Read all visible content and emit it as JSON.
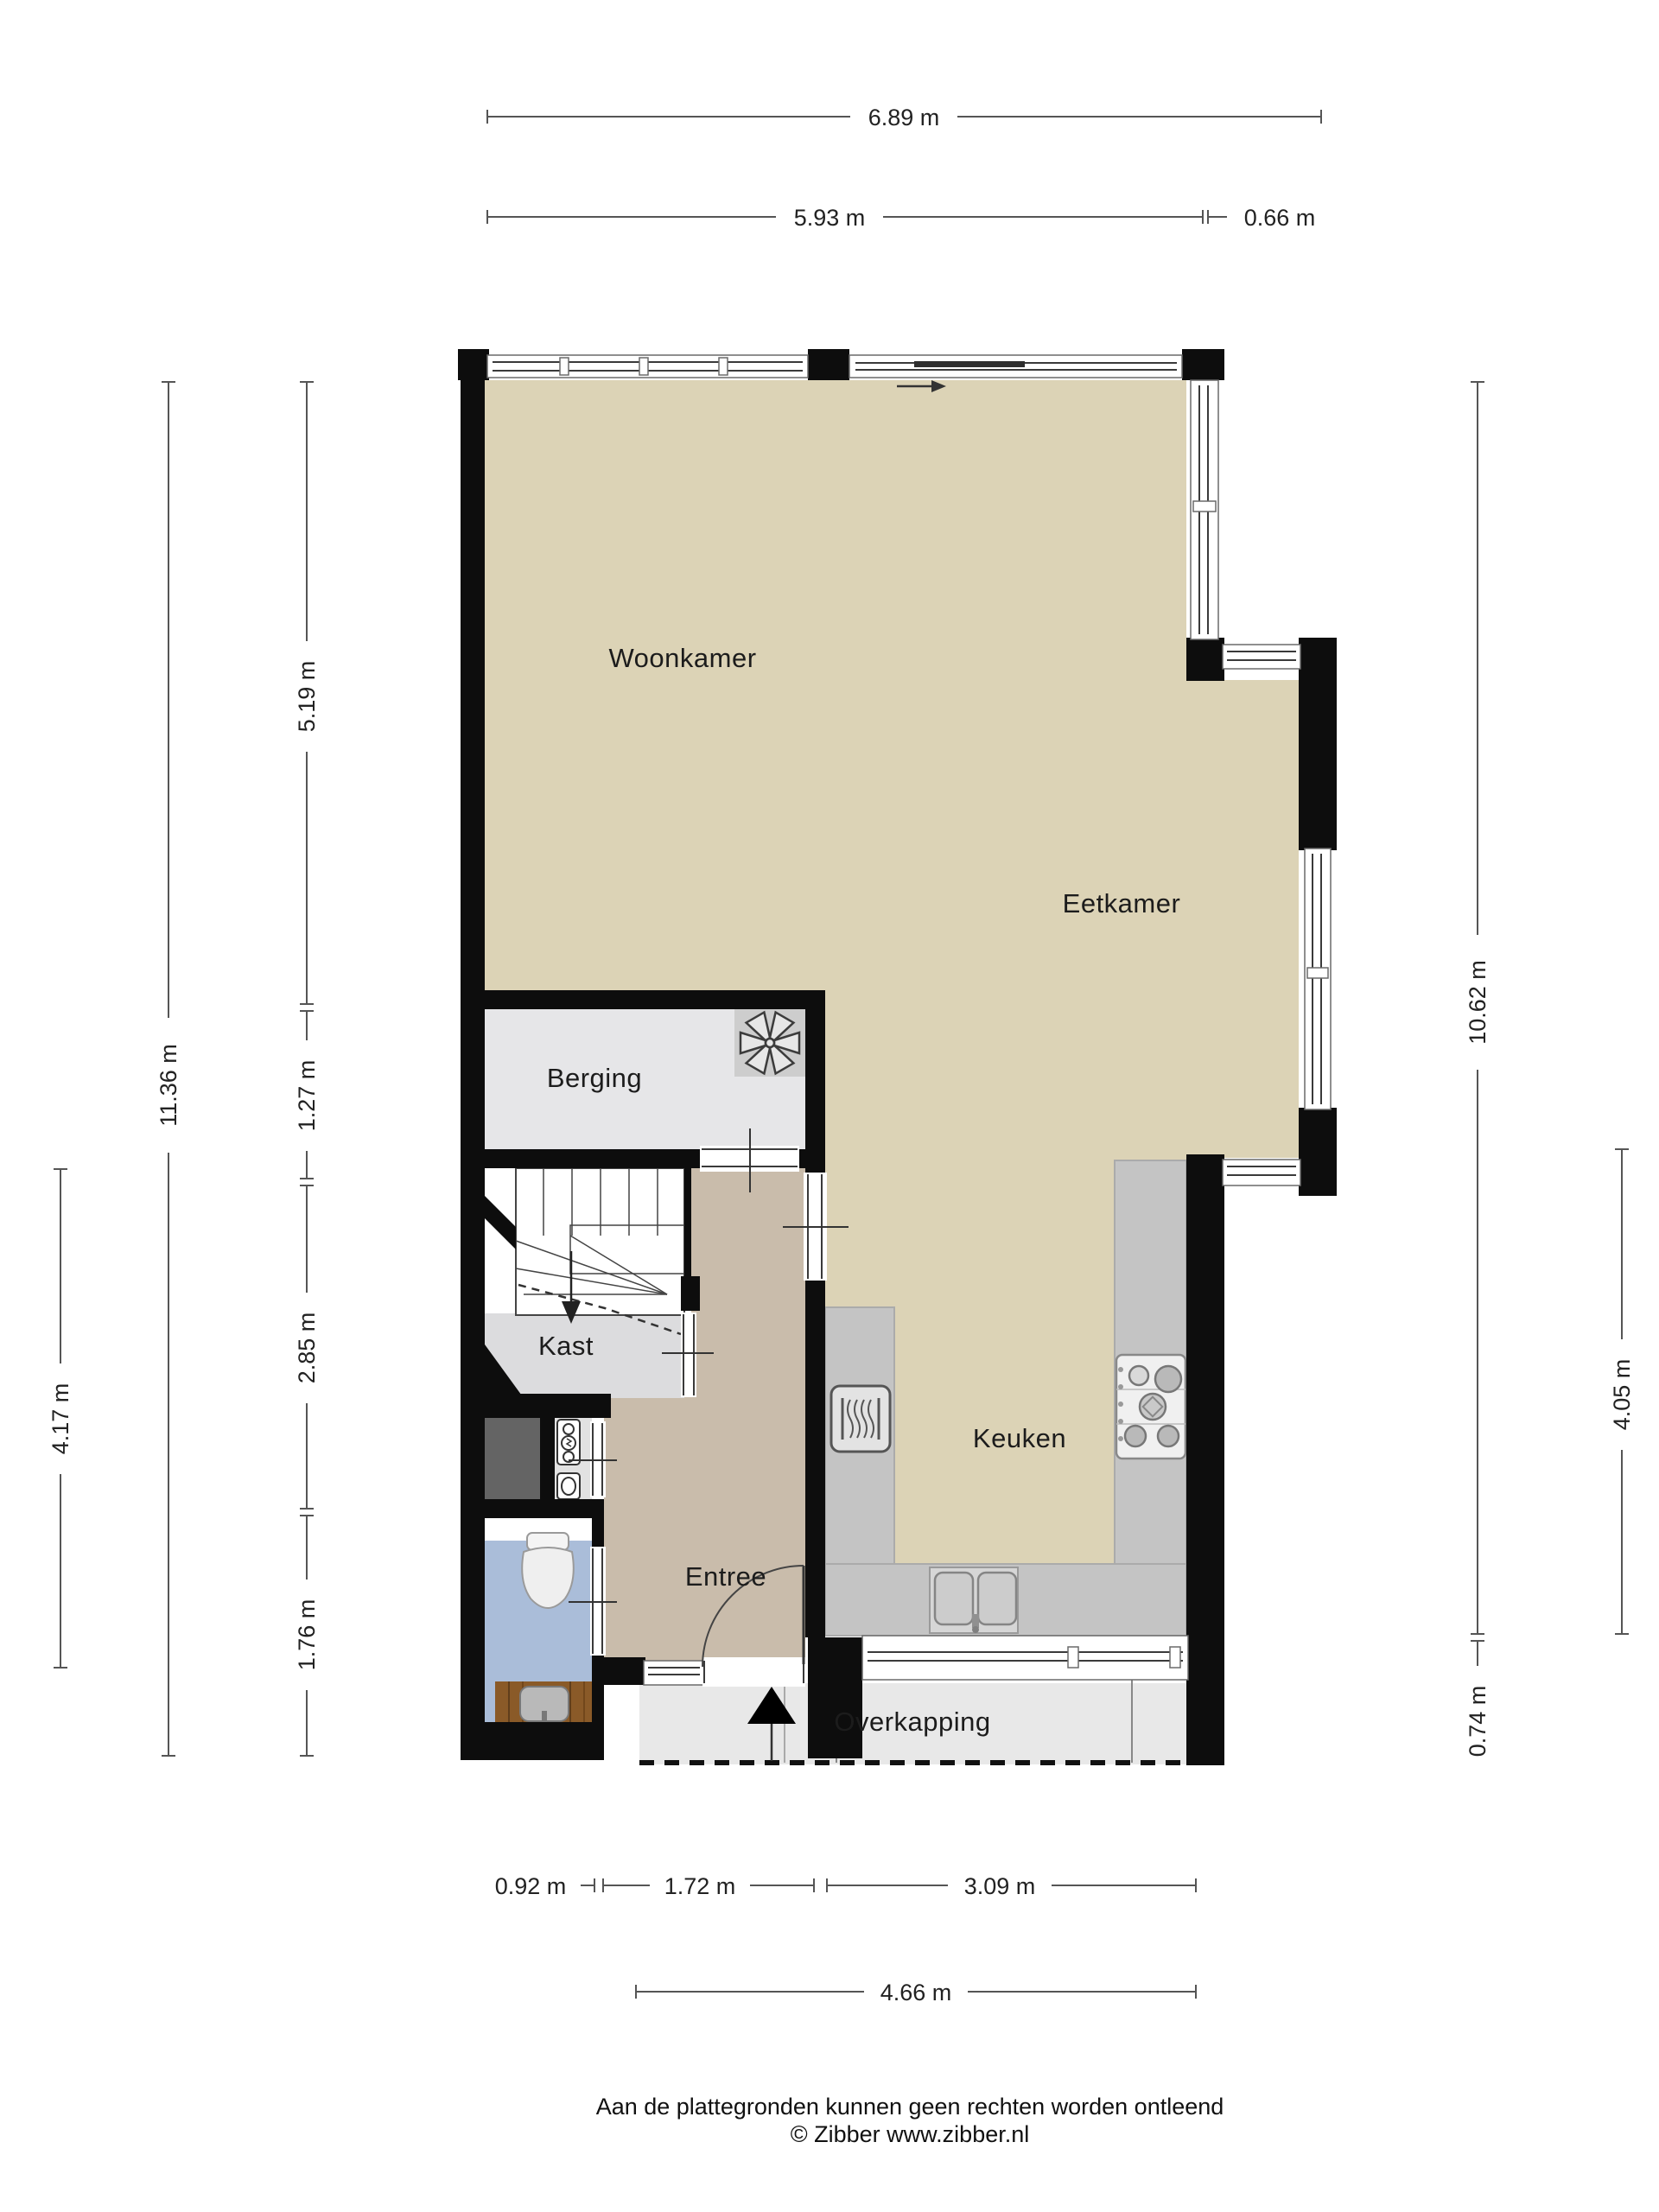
{
  "rooms": {
    "woonkamer": "Woonkamer",
    "eetkamer": "Eetkamer",
    "berging": "Berging",
    "kast": "Kast",
    "entree": "Entree",
    "keuken": "Keuken",
    "overkapping": "Overkapping"
  },
  "dims": {
    "top_total": "6.89 m",
    "top_main": "5.93 m",
    "top_right": "0.66 m",
    "left_total": "11.36 m",
    "left_seg1": "5.19 m",
    "left_seg2": "1.27 m",
    "left_seg3": "2.85 m",
    "left_seg4": "1.76 m",
    "left_inner": "4.17 m",
    "right_total": "10.62 m",
    "right_seg1": "4.05 m",
    "right_seg2": "0.74 m",
    "bottom_seg1": "0.92 m",
    "bottom_seg2": "1.72 m",
    "bottom_seg3": "3.09 m",
    "bottom_total": "4.66 m"
  },
  "footer": {
    "line1": "Aan de plattegronden kunnen geen rechten worden ontleend",
    "line2": "© Zibber www.zibber.nl"
  },
  "icons": {
    "fan": "ventilation-fan",
    "oven": "oven",
    "stove": "gas-hob-5-burners",
    "sink": "double-sink",
    "toilet": "toilet",
    "washbasin": "washbasin-cabinet",
    "entrance": "entrance-triangle",
    "slider": "sliding-door-arrow"
  },
  "colors": {
    "floor_main": "#dcd3b6",
    "floor_entree": "#c9bcab",
    "floor_berging": "#e6e6e8",
    "floor_kast": "#dcdcde",
    "floor_toilet": "#aabdd9",
    "meterkast": "#646464",
    "counter": "#c4c4c4",
    "porch": "#e8e8e8",
    "wood": "#8a5a28",
    "wall": "#0d0d0d"
  }
}
